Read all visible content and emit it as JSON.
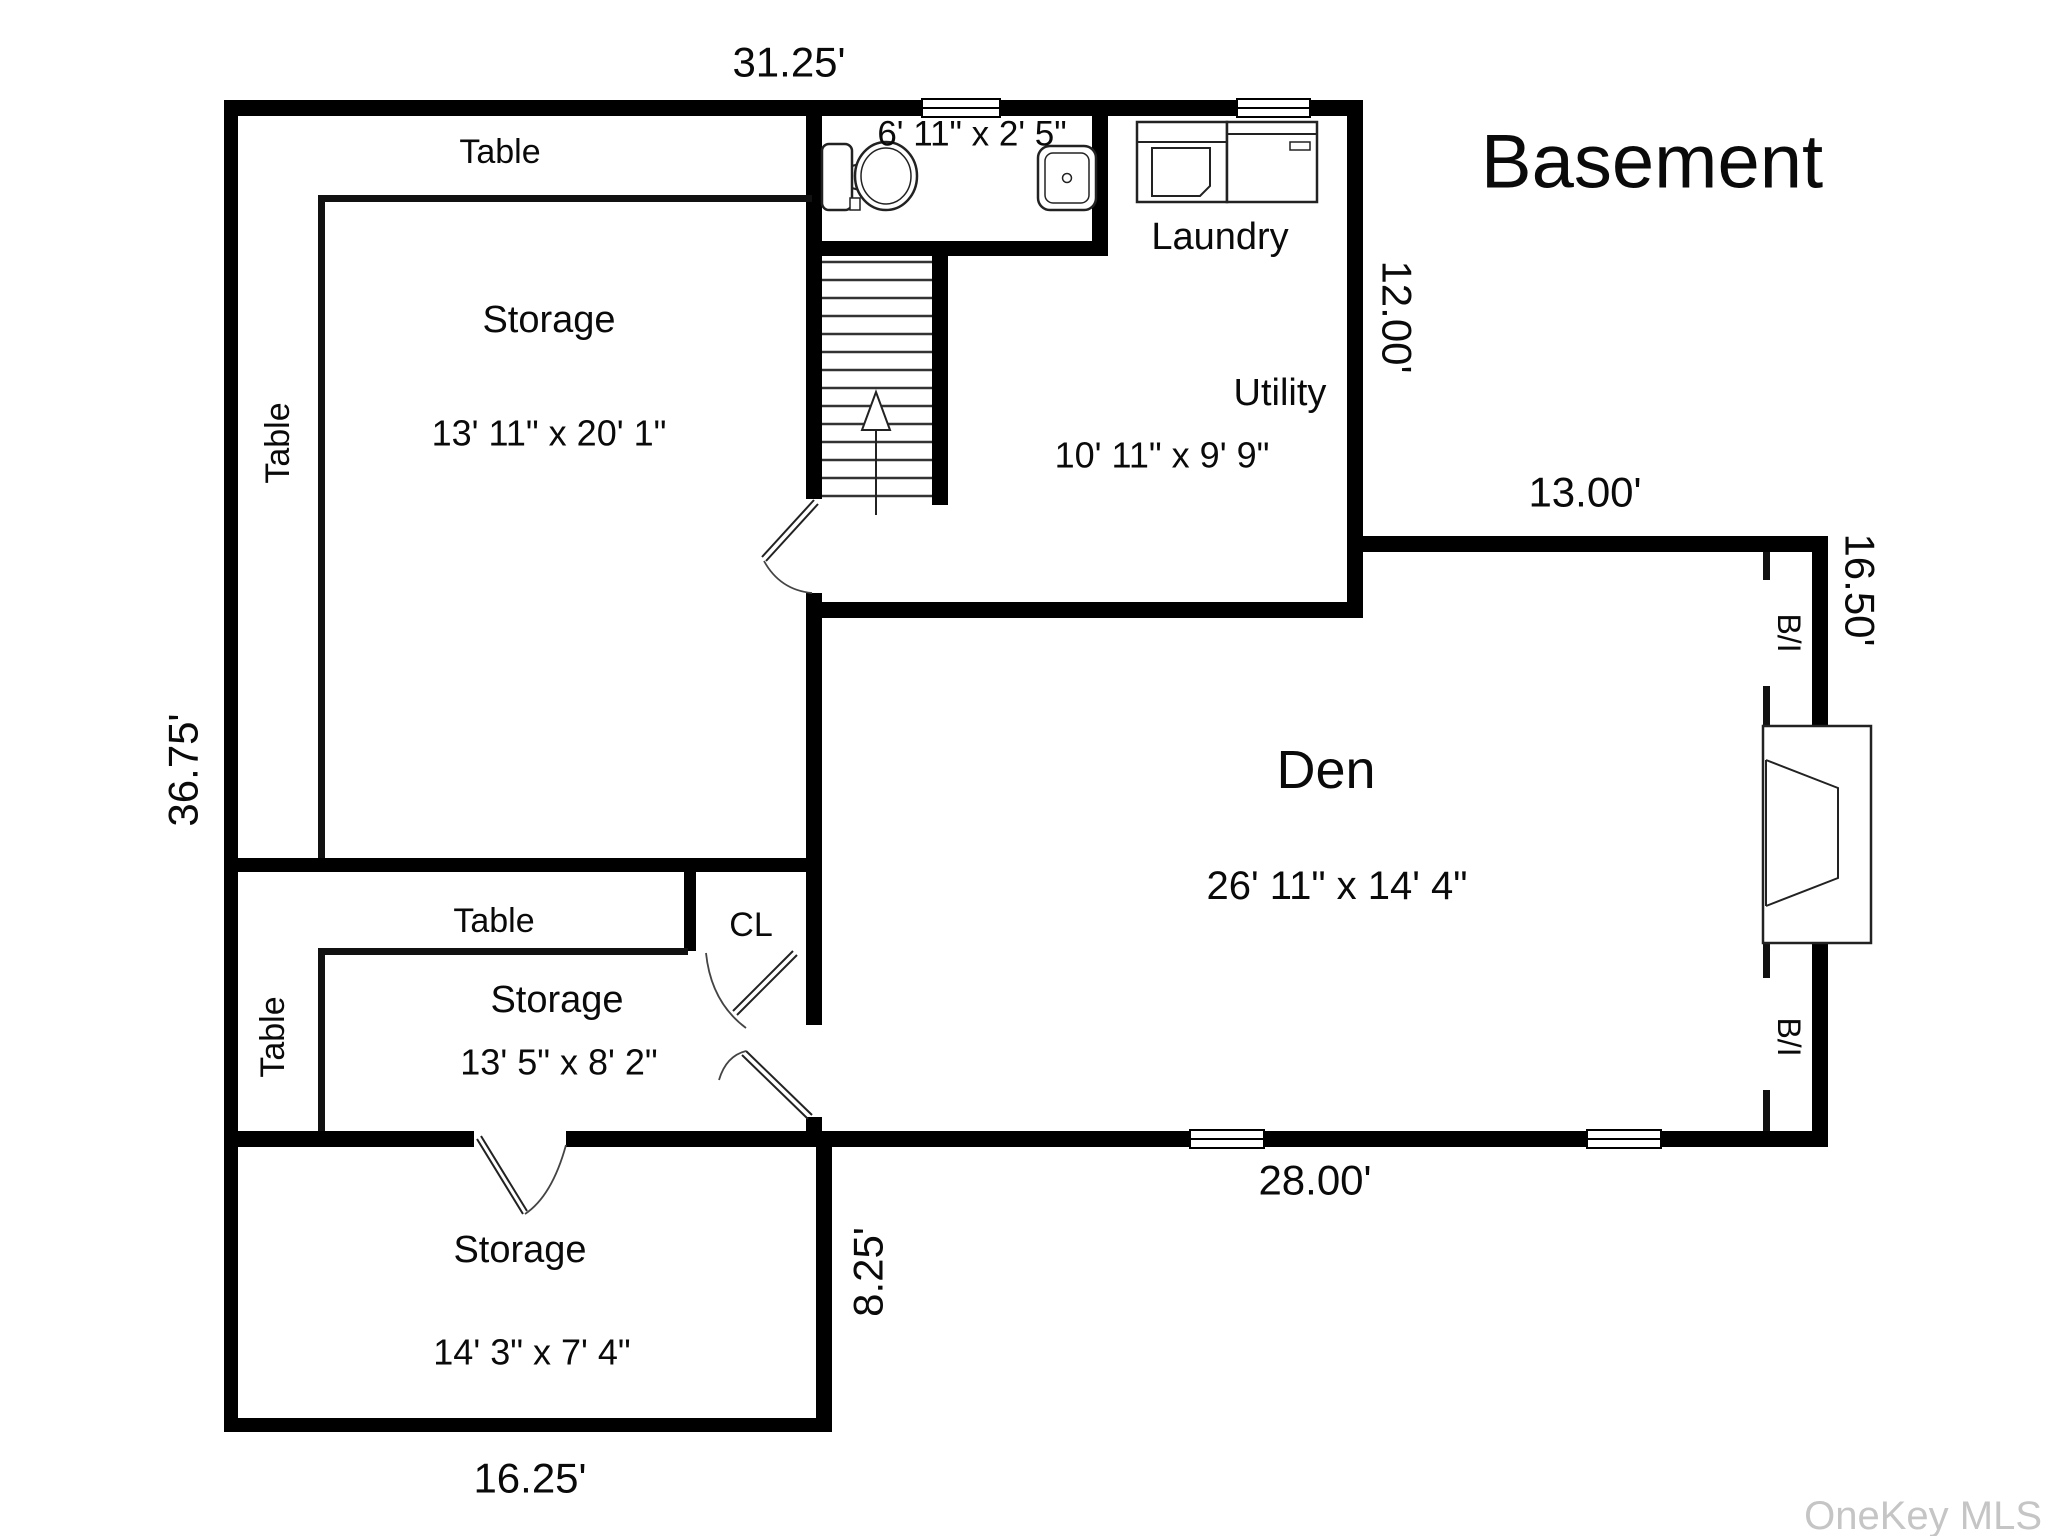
{
  "title": "Basement",
  "watermark": "OneKey MLS",
  "colors": {
    "wall": "#000000",
    "background": "#ffffff",
    "thin_line": "#111111",
    "watermark": "#c5c5c5",
    "text": "#0a0a0a"
  },
  "dimensions": {
    "top_width": "31.25'",
    "left_height": "36.75'",
    "utility_right_height": "12.00'",
    "den_top_width": "13.00'",
    "den_right_height": "16.50'",
    "den_bottom_width": "28.00'",
    "storage_bottom_right_height": "8.25'",
    "bottom_width": "16.25'"
  },
  "rooms": {
    "storage_top": {
      "name": "Storage",
      "dims": "13' 11\" x 20' 1\""
    },
    "bathroom": {
      "dims": "6' 11\" x 2' 5\""
    },
    "laundry": {
      "name": "Laundry"
    },
    "utility": {
      "name": "Utility",
      "dims": "10' 11\" x 9' 9\""
    },
    "den": {
      "name": "Den",
      "dims": "26' 11\" x 14' 4\""
    },
    "closet": {
      "name": "CL"
    },
    "storage_middle": {
      "name": "Storage",
      "dims": "13' 5\" x 8' 2\""
    },
    "storage_bottom": {
      "name": "Storage",
      "dims": "14' 3\" x 7' 4\""
    }
  },
  "furniture": {
    "table_top": "Table",
    "table_left": "Table",
    "table_middle": "Table",
    "table_bottom_left": "Table",
    "built_in_top": "B/I",
    "built_in_bottom": "B/I"
  }
}
